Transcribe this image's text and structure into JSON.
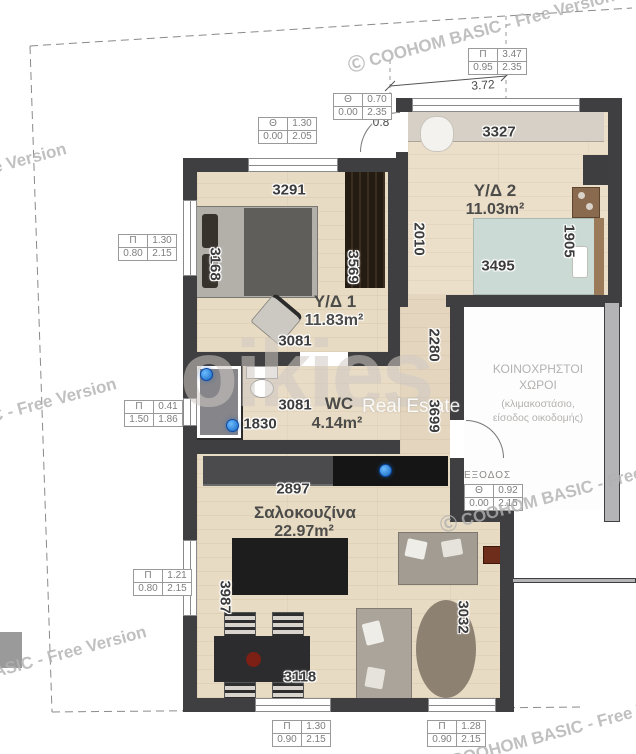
{
  "watermark": {
    "brand": "Ⓒ COOHOM BASIC - Free Version",
    "logo": "oikies",
    "logo_sub": "Real Estate"
  },
  "rooms": {
    "bedroom1": {
      "name": "Υ/Δ 1",
      "area": "11.83m²"
    },
    "bedroom2": {
      "name": "Υ/Δ 2",
      "area": "11.03m²"
    },
    "wc": {
      "name": "WC",
      "area": "4.14m²"
    },
    "living": {
      "name": "Σαλοκουζίνα",
      "area": "22.97m²"
    },
    "common": {
      "name_line1": "ΚΟΙΝΟΧΡΗΣΤΟΙ",
      "name_line2": "ΧΩΡΟΙ",
      "desc_line1": "(κλιμακοστάσιο,",
      "desc_line2": "είσοδος οικοδομής)"
    },
    "exit_label": "ΕΞΟΔΟΣ"
  },
  "dimensions": {
    "bedroom1_top": "3291",
    "bedroom1_left": "3168",
    "bedroom1_right": "3569",
    "bedroom1_bottom": "3081",
    "bedroom2_top": "3327",
    "bedroom2_left": "2010",
    "bedroom2_right": "1905",
    "bedroom2_bed": "3495",
    "wc_width": "3081",
    "wc_left": "1830",
    "corridor_upper": "2280",
    "corridor_lower": "3699",
    "living_top": "2897",
    "living_left": "3987",
    "living_table": "3118",
    "living_right": "3032",
    "site_width": "3.72",
    "door_leaf": "0.8"
  },
  "opening_tables": [
    {
      "id": "window-top-right",
      "symbol": "Π",
      "width": "3.47",
      "sill": "0.95",
      "height": "2.35"
    },
    {
      "id": "door-top",
      "symbol": "Θ",
      "width": "0.70",
      "sill": "0.00",
      "height": "2.35"
    },
    {
      "id": "window-top-left",
      "symbol": "Θ",
      "width": "1.30",
      "sill": "0.00",
      "height": "2.05"
    },
    {
      "id": "window-left-upper",
      "symbol": "Π",
      "width": "1.30",
      "sill": "0.80",
      "height": "2.15"
    },
    {
      "id": "window-left-middle",
      "symbol": "Π",
      "width": "0.41",
      "sill": "1.50",
      "height": "1.86"
    },
    {
      "id": "window-left-lower",
      "symbol": "Π",
      "width": "1.21",
      "sill": "0.80",
      "height": "2.15"
    },
    {
      "id": "door-exit",
      "symbol": "Θ",
      "width": "0.92",
      "sill": "0.00",
      "height": "2.15"
    },
    {
      "id": "window-bottom-left",
      "symbol": "Π",
      "width": "1.30",
      "sill": "0.90",
      "height": "2.15"
    },
    {
      "id": "window-bottom-right",
      "symbol": "Π",
      "width": "1.28",
      "sill": "0.90",
      "height": "2.15"
    }
  ],
  "colors": {
    "wall": "#3f3f41",
    "floor": "#e8dbc3",
    "bed2": "#cbdad4",
    "marker": "#1e73d2",
    "watermark": "#c9c9c9"
  }
}
